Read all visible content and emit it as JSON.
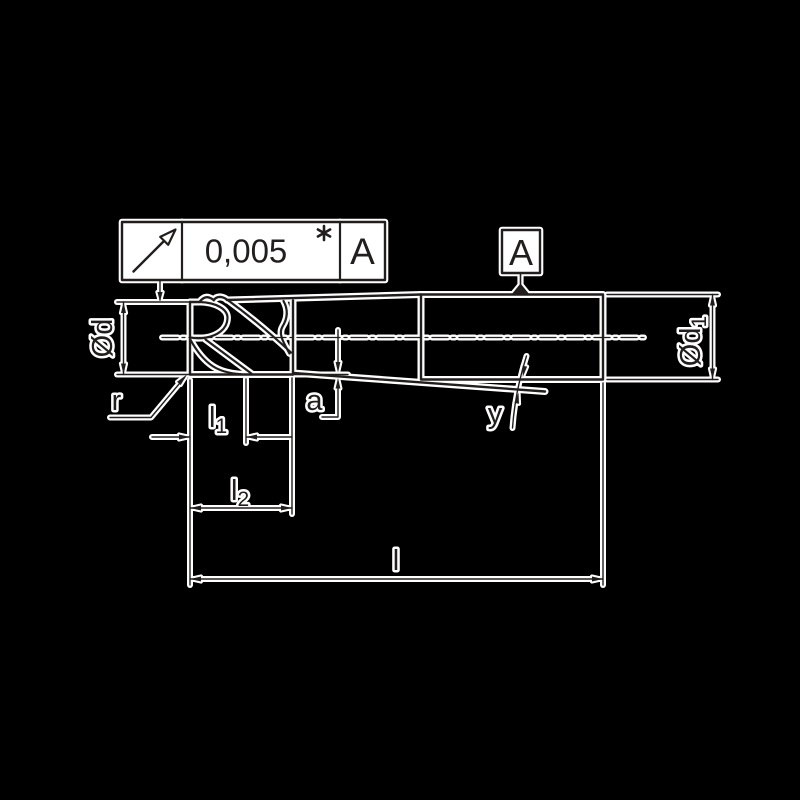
{
  "colors": {
    "background": "#000000",
    "ink": "#221e1d",
    "halo": "#ffffff"
  },
  "tolerance_frame": {
    "symbol_icon": "runout-arrow",
    "value": "0,005",
    "marker_icon": "asterisk",
    "datum": "A"
  },
  "datum_flag": {
    "label": "A"
  },
  "labels": {
    "d": {
      "base": "Ød",
      "sub": ""
    },
    "d1": {
      "base": "Ød",
      "sub": "1"
    },
    "r": "r",
    "l1": {
      "base": "l",
      "sub": "1"
    },
    "l2": {
      "base": "l",
      "sub": "2"
    },
    "l": "l",
    "a": "a",
    "y": "y"
  }
}
